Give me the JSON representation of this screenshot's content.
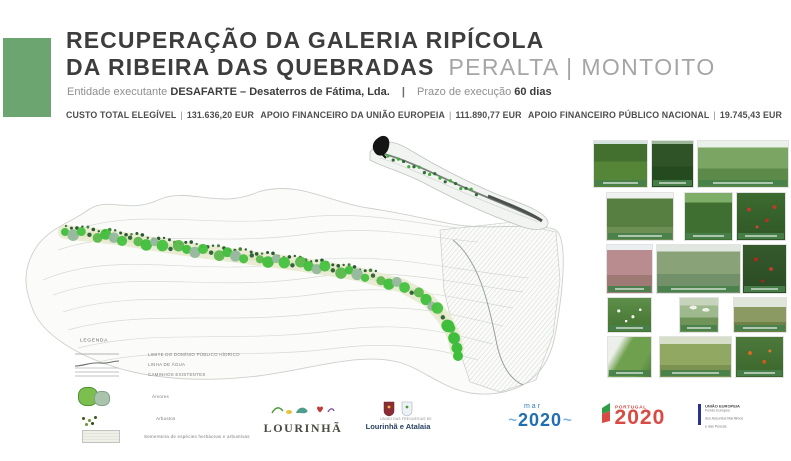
{
  "header": {
    "title_line1": "RECUPERAÇÃO DA GALERIA RIPÍCOLA",
    "title_line2": "DA RIBEIRA DAS QUEBRADAS",
    "title_location": "PERALTA | MONTOITO",
    "entity_label": "Entidade executante",
    "entity_name": "DESAFARTE – Desaterros de Fátima, Lda.",
    "divider": "|",
    "term_label": "Prazo de execução",
    "term_value": "60 dias"
  },
  "finance": [
    {
      "label": "CUSTO TOTAL ELEGÍVEL",
      "sep": "|",
      "value": "131.636,20 EUR"
    },
    {
      "label": "APOIO FINANCEIRO DA UNIÃO EUROPEIA",
      "sep": "|",
      "value": "111.890,77 EUR"
    },
    {
      "label": "APOIO FINANCEIRO PÚBLICO NACIONAL",
      "sep": "|",
      "value": "19.745,43 EUR"
    }
  ],
  "legend": {
    "title": "LEGENDA",
    "items": [
      {
        "symbol": "boundary-line",
        "label": "LIMITE DO DOMÍNIO PÚBLICO HÍDRICO"
      },
      {
        "symbol": "water-line",
        "label": "LINHA DE ÁGUA"
      },
      {
        "symbol": "path-lines",
        "label": "CAMINHOS EXISTENTES"
      },
      {
        "symbol": "tree-circles",
        "label": "Árvores"
      },
      {
        "symbol": "shrub-dots",
        "label": "Arbustos"
      },
      {
        "symbol": "hatch-rect",
        "label": "Sementeira de espécies herbáceas e arbustivas"
      }
    ]
  },
  "plants": {
    "rows": [
      3,
      3,
      3,
      3,
      3
    ],
    "labels": [
      "",
      "",
      "",
      "",
      "",
      "",
      "",
      "",
      "",
      "",
      "",
      "",
      "",
      "",
      ""
    ]
  },
  "footer": {
    "municipality": "LOURINHÃ",
    "parish_small": "UNIÃO DAS FREGUESIAS DE",
    "parish": "Lourinhã e Atalaia",
    "mar_label": "mar",
    "mar_wave": "~",
    "mar_year": "2020",
    "portugal_label": "PORTUGAL",
    "portugal_year": "2020",
    "eu_title": "UNIÃO EUROPEIA",
    "eu_fund_line1": "Fundo Europeu",
    "eu_fund_line2": "dos Assuntos Marítimos",
    "eu_fund_line3": "e das Pescas"
  },
  "colors": {
    "accent_green": "#6da570",
    "tree_green": "#3fbe3c",
    "tree_sage": "#93b79c",
    "label_bar_green": "#488048",
    "mar_blue": "#1f6fb2",
    "portugal_red": "#d94a43",
    "eu_blue": "#27348b"
  }
}
